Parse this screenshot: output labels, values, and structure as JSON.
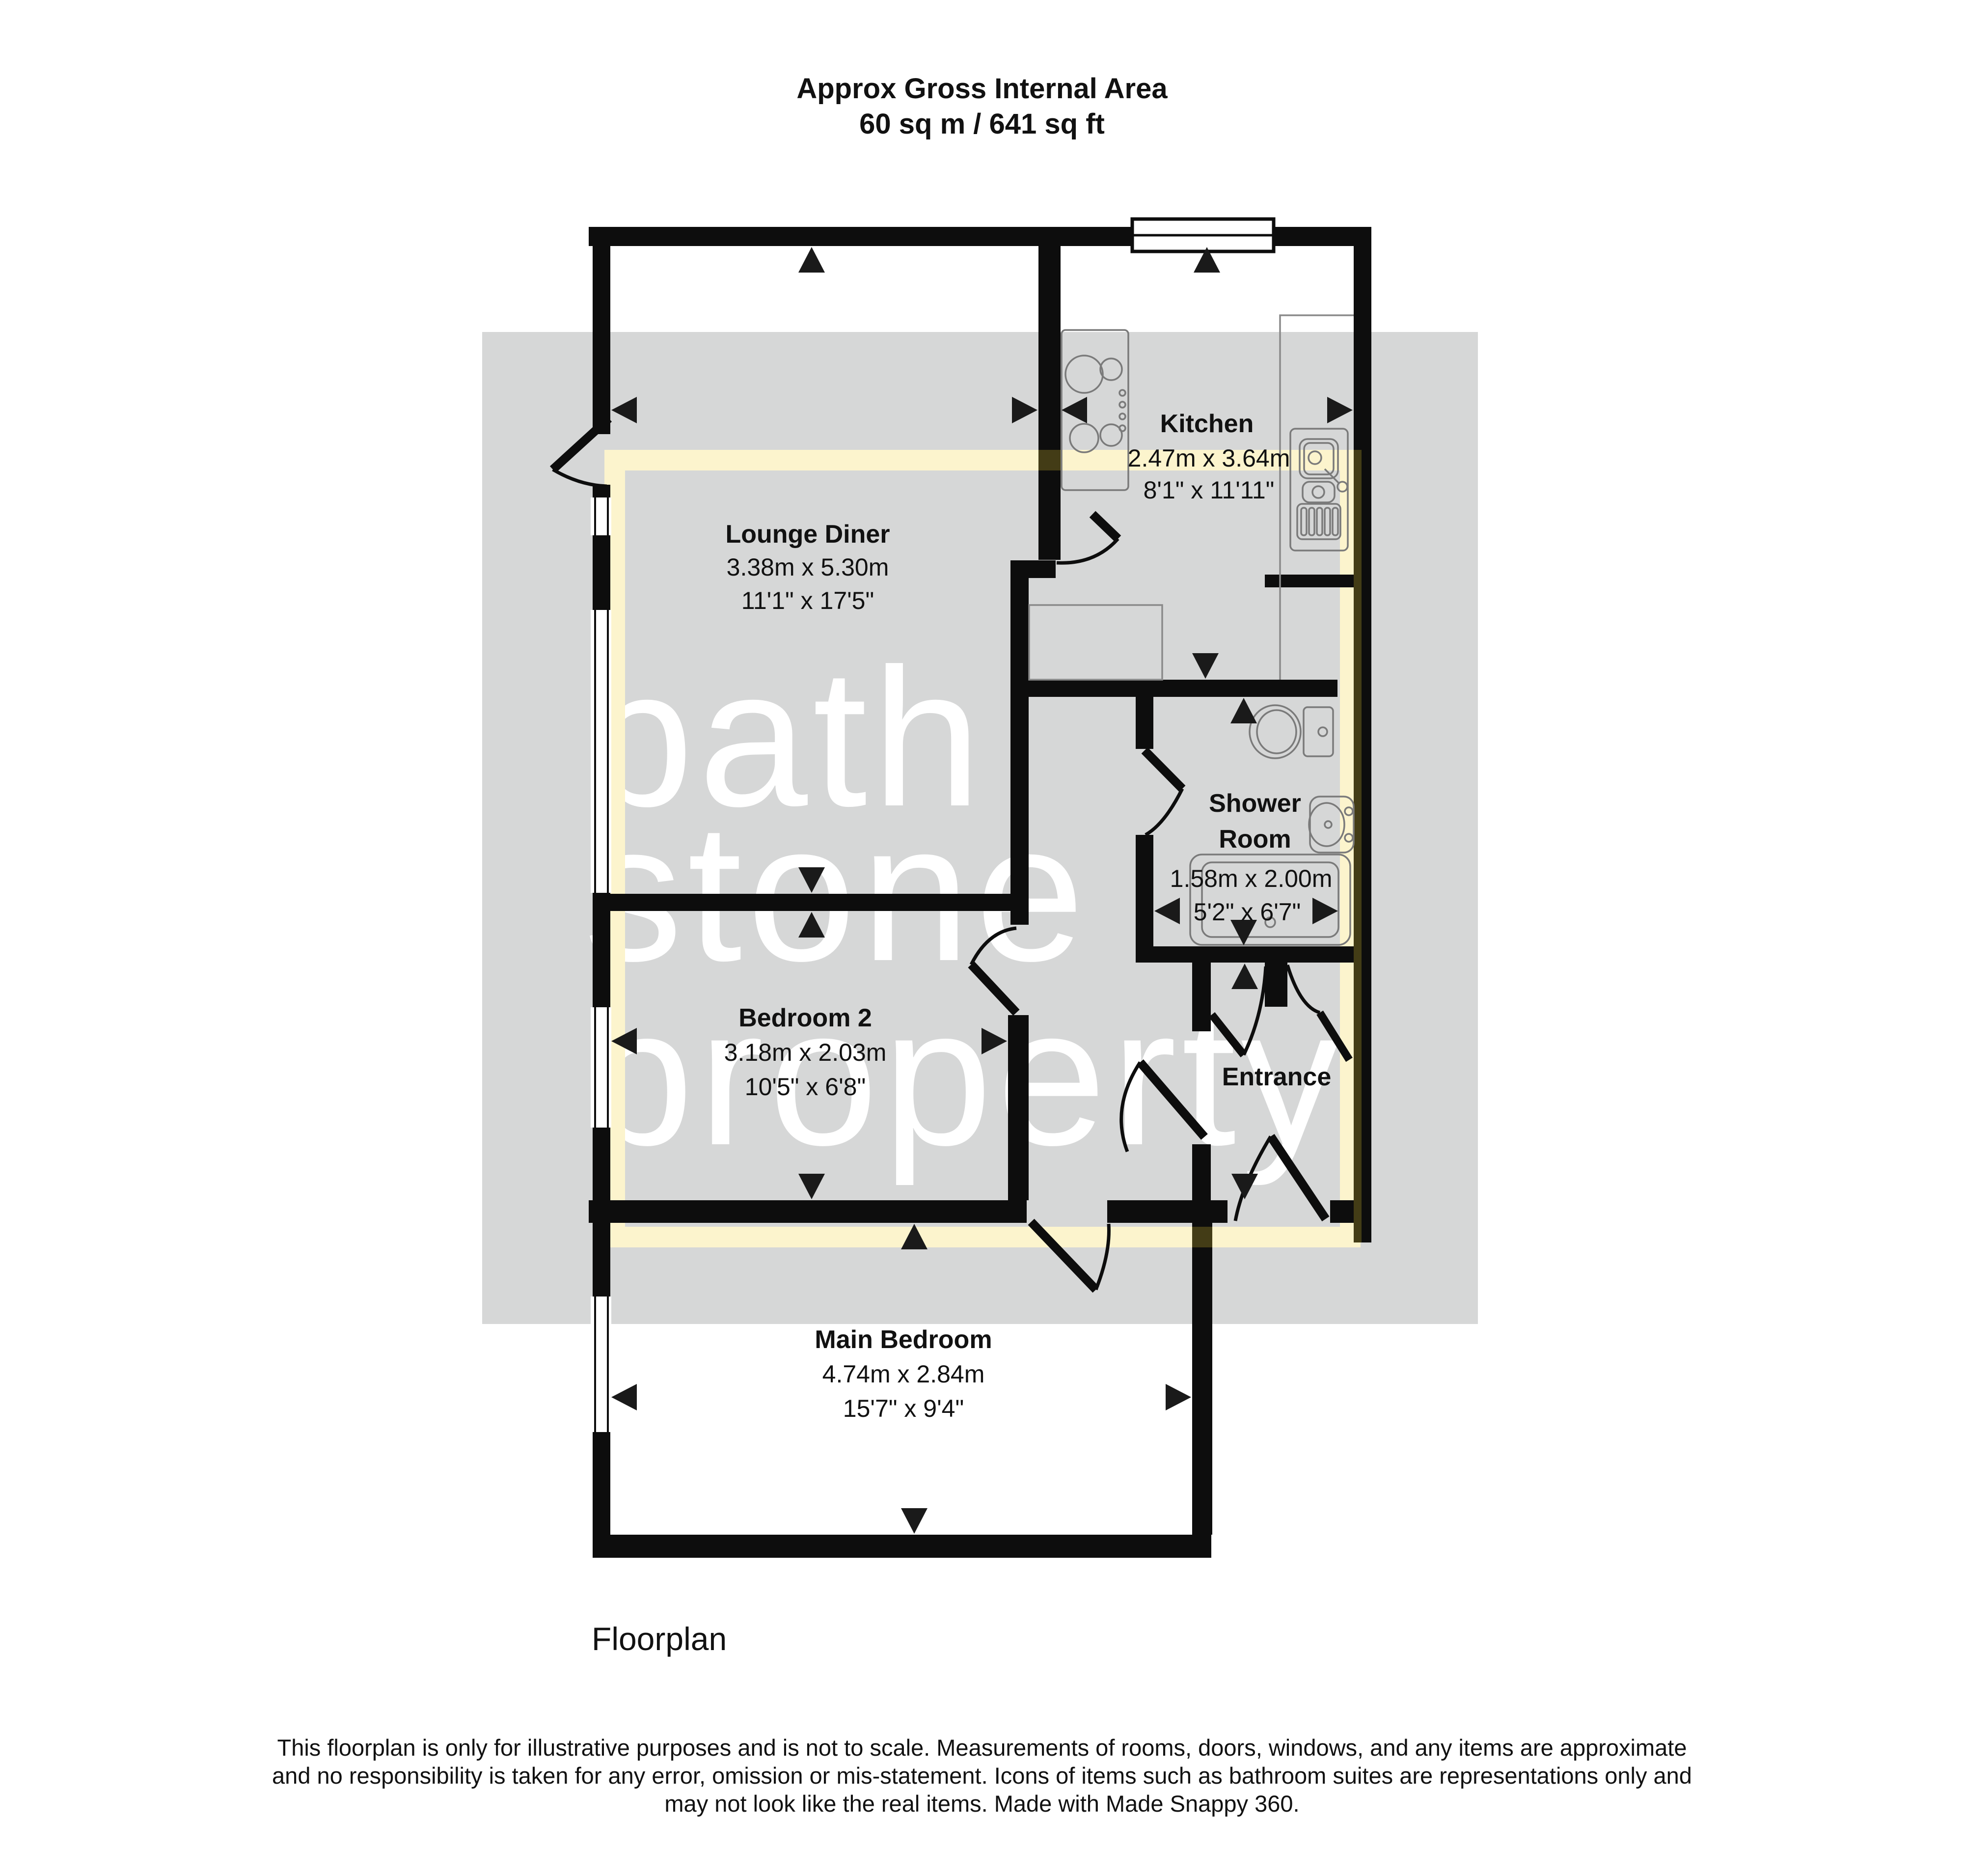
{
  "title": {
    "line1": "Approx Gross Internal Area",
    "line2": "60 sq m / 641 sq ft"
  },
  "watermark": {
    "line1": "bath",
    "line2": "stone",
    "line3": "property"
  },
  "rooms": {
    "lounge": {
      "name": "Lounge Diner",
      "metric": "3.38m x 5.30m",
      "imperial": "11'1\" x 17'5\""
    },
    "kitchen": {
      "name": "Kitchen",
      "metric": "2.47m x 3.64m",
      "imperial": "8'1\" x 11'11\""
    },
    "shower": {
      "name_line1": "Shower",
      "name_line2": "Room",
      "metric": "1.58m x 2.00m",
      "imperial": "5'2\" x 6'7\""
    },
    "bedroom2": {
      "name": "Bedroom 2",
      "metric": "3.18m x 2.03m",
      "imperial": "10'5\" x 6'8\""
    },
    "entrance": {
      "name": "Entrance"
    },
    "main_bedroom": {
      "name": "Main Bedroom",
      "metric": "4.74m x 2.84m",
      "imperial": "15'7\" x 9'4\""
    }
  },
  "footer": {
    "label": "Floorplan",
    "disclaimer_line1": "This floorplan is only for illustrative purposes and is not to scale. Measurements of rooms, doors, windows, and any items are approximate",
    "disclaimer_line2": "and no responsibility is taken for any error, omission or mis-statement. Icons of items such as bathroom suites are representations only and",
    "disclaimer_line3": "may not look like the real items. Made with Made Snappy 360."
  },
  "colors": {
    "wall": "#0d0d0d",
    "watermark_overlay": "#d6d7d7",
    "highlight": "#FCF4CD",
    "highlight_on_wall": "#433C16",
    "fixture": "#7a7a7a",
    "background": "#ffffff"
  }
}
